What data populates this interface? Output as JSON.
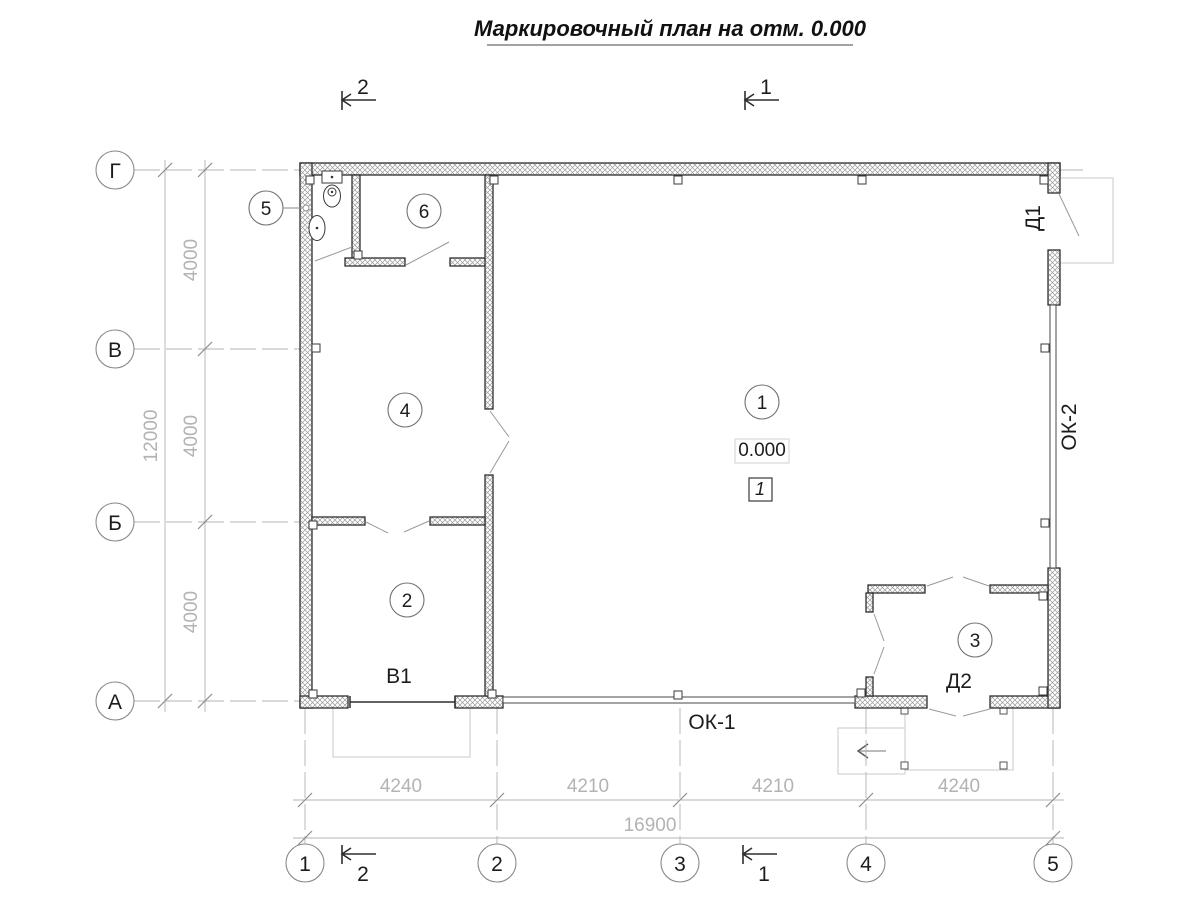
{
  "title": "Маркировочный план на отм. 0.000",
  "axes": {
    "rows": [
      "Г",
      "В",
      "Б",
      "А"
    ],
    "cols": [
      "1",
      "2",
      "3",
      "4",
      "5"
    ]
  },
  "dims": {
    "left": [
      "4000",
      "4000",
      "4000"
    ],
    "left_total": "12000",
    "bottom": [
      "4240",
      "4210",
      "4210",
      "4240"
    ],
    "bottom_total": "16900"
  },
  "rooms": [
    "1",
    "2",
    "3",
    "4",
    "5",
    "6"
  ],
  "marks": {
    "door_d1": "Д1",
    "door_d2": "Д2",
    "gate_v1": "В1",
    "window_ok1": "ОК-1",
    "window_ok2": "ОК-2",
    "elevation": "0.000",
    "floor_type": "1"
  },
  "sections": {
    "one": "1",
    "two": "2"
  },
  "colors": {
    "wall_outline": "#2e2e2e",
    "dimension_text": "#b3b3b3",
    "porch_outline": "#c9c9c9",
    "swing_line": "#9a9a9a"
  }
}
